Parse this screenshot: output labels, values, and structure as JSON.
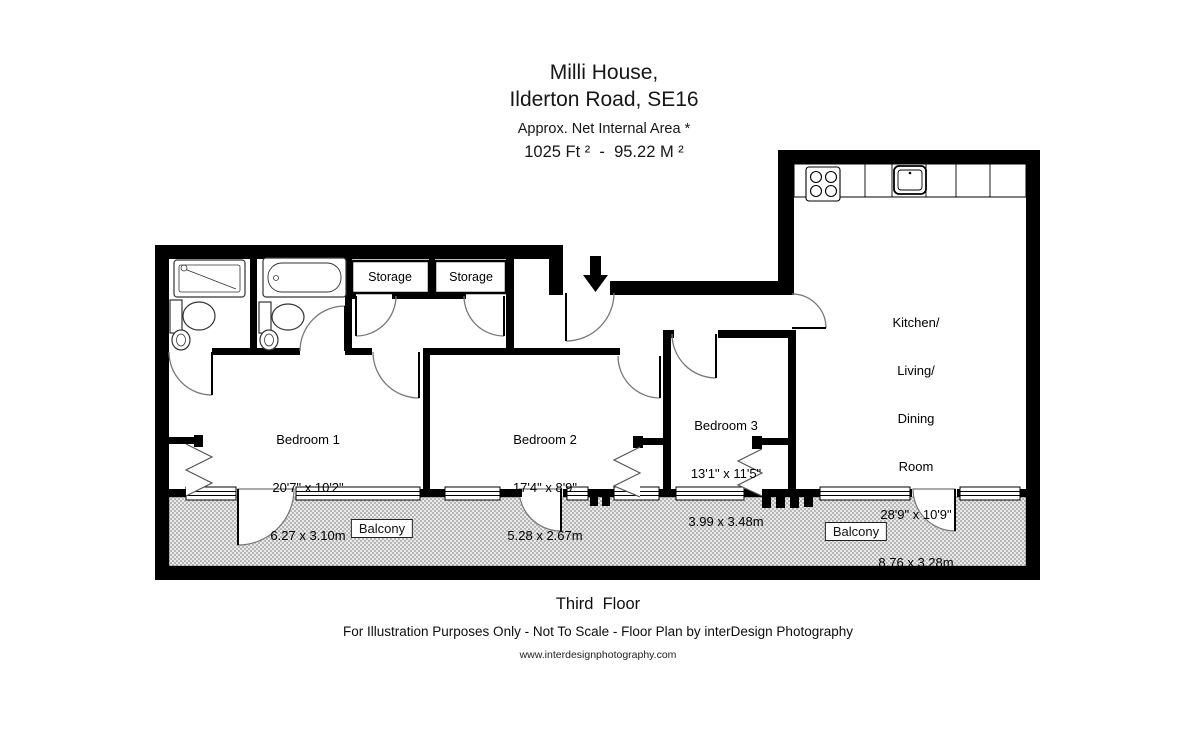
{
  "title": {
    "line1": "Milli House,",
    "line2": "Ilderton Road, SE16",
    "subtitle": "Approx. Net Internal Area *",
    "area": "1025 Ft ²  -  95.22 M ²"
  },
  "rooms": {
    "bedroom1": {
      "name": "Bedroom 1",
      "imperial": "20'7\" x 10'2\"",
      "metric": "6.27 x 3.10m"
    },
    "bedroom2": {
      "name": "Bedroom 2",
      "imperial": "17'4\" x 8'9\"",
      "metric": "5.28 x 2.67m"
    },
    "bedroom3": {
      "name": "Bedroom 3",
      "imperial": "13'1\" x 11'5\"",
      "metric": "3.99 x 3.48m"
    },
    "kitchen": {
      "line1": "Kitchen/",
      "line2": "Living/",
      "line3": "Dining",
      "line4": "Room",
      "imperial": "28'9\" x 10'9\"",
      "metric": "8.76 x 3.28m"
    },
    "storage1": {
      "name": "Storage"
    },
    "storage2": {
      "name": "Storage"
    },
    "balcony_left": {
      "name": "Balcony"
    },
    "balcony_right": {
      "name": "Balcony"
    }
  },
  "footer": {
    "floor": "Third  Floor",
    "disclaimer": "For Illustration Purposes Only - Not To Scale - Floor Plan by interDesign Photography",
    "website": "www.interdesignphotography.com"
  },
  "icons": {
    "entrance_arrow": "down-arrow"
  },
  "colors": {
    "wall": "#000000",
    "balcony_hatch": "#b7b7b7",
    "background": "#ffffff",
    "door_arc": "#777777"
  }
}
